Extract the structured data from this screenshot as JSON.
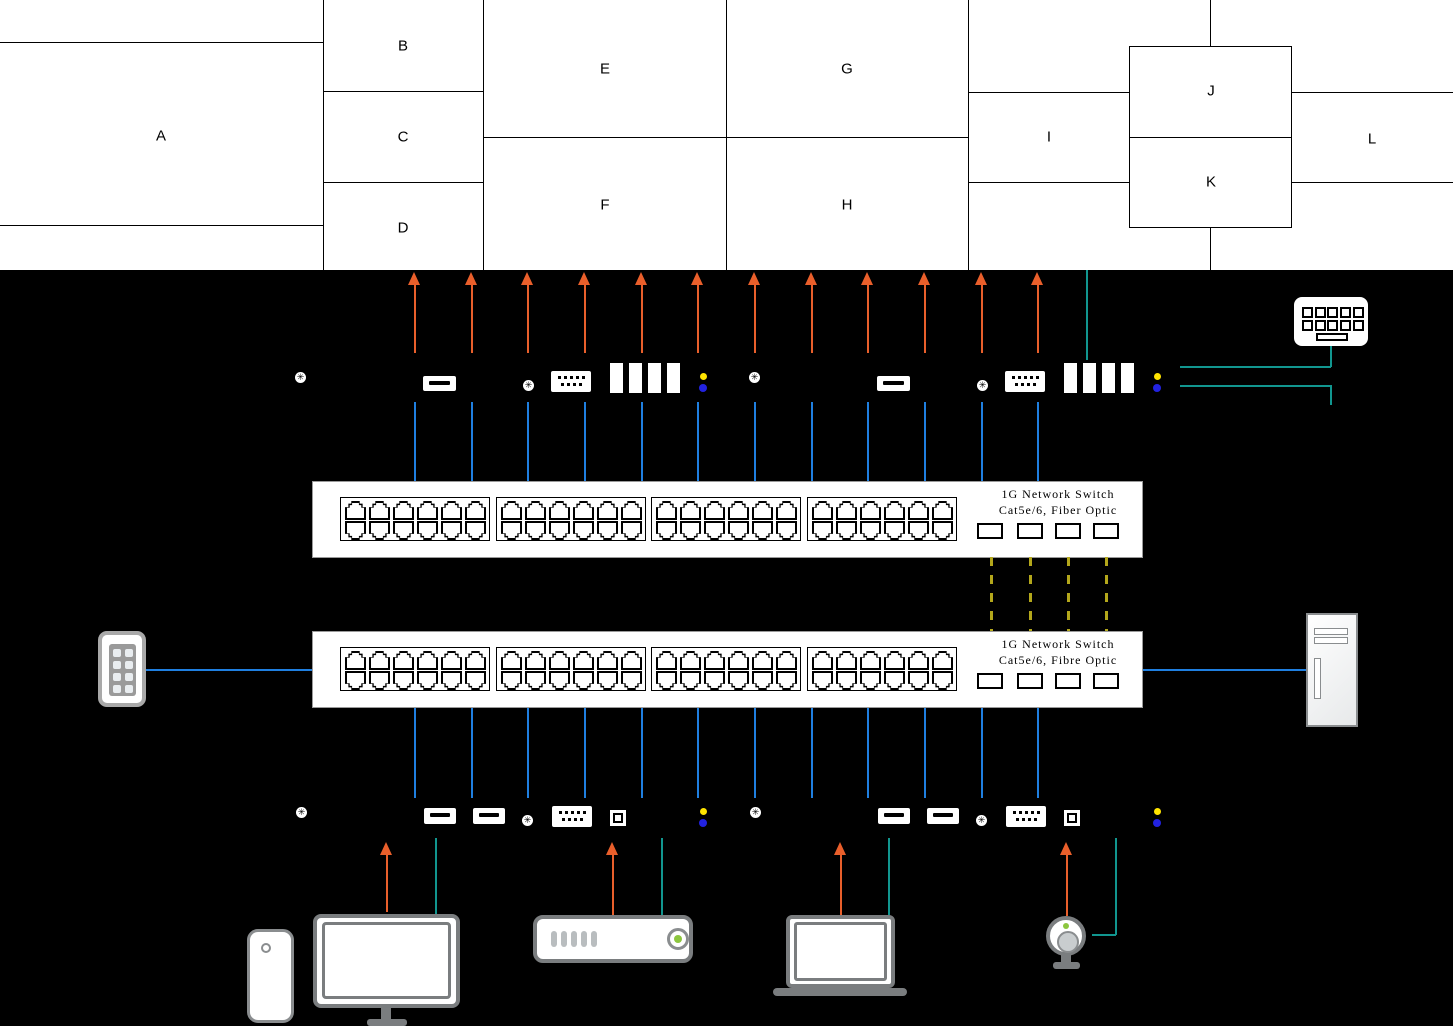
{
  "wall": {
    "regions": [
      "A",
      "B",
      "C",
      "D",
      "E",
      "F",
      "G",
      "H",
      "I",
      "J",
      "K",
      "L"
    ]
  },
  "switch_top": {
    "name_line": "1G Network Switch",
    "spec_line": "Cat5e/6, Fiber Optic"
  },
  "switch_bottom": {
    "name_line": "1G Network Switch",
    "spec_line": "Cat5e/6, Fibre Optic"
  },
  "icons": {
    "screw_glyph": "✳",
    "decoders": [
      "decoder-unit-1-icon",
      "decoder-unit-2-icon"
    ],
    "encoders": [
      "encoder-unit-1-icon",
      "encoder-unit-2-icon"
    ],
    "sources": [
      "smartphone-icon",
      "desktop-monitor-icon",
      "media-player-icon",
      "laptop-icon",
      "webcam-icon"
    ],
    "peripherals": [
      "keyboard-icon",
      "control-keypad-icon",
      "pc-tower-icon"
    ]
  },
  "colors": {
    "video_arrow_orange": "#e95f2b",
    "ethernet_blue": "#1f7fe0",
    "usb_teal": "#11968f",
    "fiber_yellow": "#b3a71b",
    "led_yellow": "#ffe400",
    "led_blue": "#2222e0",
    "power_green": "#8cc63f"
  }
}
